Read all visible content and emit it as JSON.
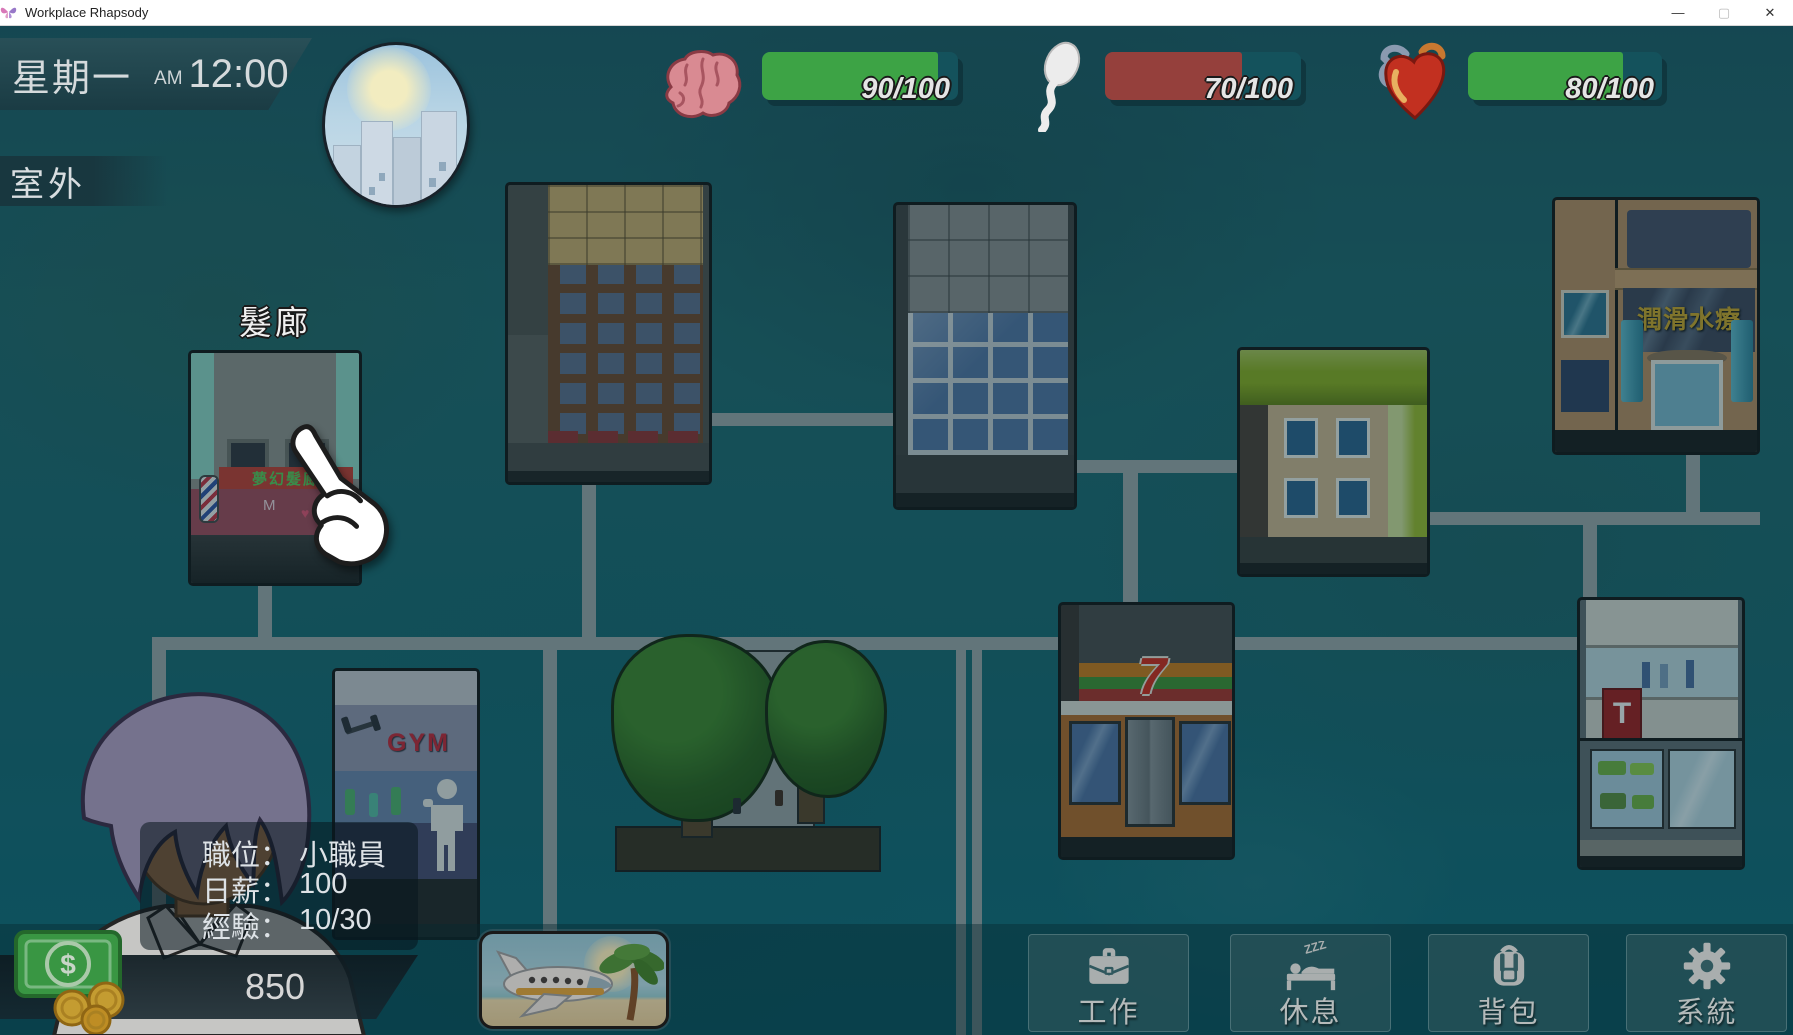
{
  "window": {
    "title": "Workplace Rhapsody",
    "app_icon": "butterfly-icon",
    "controls": {
      "minimize": "—",
      "maximize": "▢",
      "close": "✕"
    }
  },
  "hud": {
    "day": "星期一",
    "meridiem": "AM",
    "time": "12:00",
    "location": "室外",
    "weather_icon": "city-sunrise-icon",
    "track_color": "#14525c",
    "stats": [
      {
        "id": "intellect",
        "icon": "brain-icon",
        "value": 90,
        "max": 100,
        "label": "90/100",
        "fill_color": "#3da345"
      },
      {
        "id": "libido",
        "icon": "sperm-icon",
        "value": 70,
        "max": 100,
        "label": "70/100",
        "fill_color": "#95403c"
      },
      {
        "id": "health",
        "icon": "heart-icon",
        "value": 80,
        "max": 100,
        "label": "80/100",
        "fill_color": "#3da345"
      }
    ]
  },
  "map": {
    "buildings": [
      {
        "id": "hair-salon",
        "label": "髮廊",
        "sign": "夢幻髮廊",
        "front_letter": "M",
        "front_heart": "♥"
      },
      {
        "id": "apartment"
      },
      {
        "id": "office-tower"
      },
      {
        "id": "green-house"
      },
      {
        "id": "spa",
        "sign": "潤滑水療"
      },
      {
        "id": "gym",
        "sign": "GYM"
      },
      {
        "id": "park"
      },
      {
        "id": "convenience-store",
        "sign": "7"
      },
      {
        "id": "toy-store",
        "sign": "T"
      }
    ]
  },
  "player": {
    "avatar": "office-worker-portrait",
    "info": [
      {
        "label": "職位：",
        "value": "小職員"
      },
      {
        "label": "日薪：",
        "value": "100"
      },
      {
        "label": "經驗：",
        "value": "10/30"
      }
    ],
    "money": "850",
    "money_symbol": "$",
    "money_icon": "cash-and-coins-icon"
  },
  "actions": {
    "travel_icon": "airplane-vacation-icon",
    "buttons": [
      {
        "id": "work",
        "icon": "briefcase-icon",
        "label": "工作"
      },
      {
        "id": "rest",
        "icon": "bed-icon",
        "label": "休息",
        "zzz": "ZZZ"
      },
      {
        "id": "bag",
        "icon": "backpack-icon",
        "label": "背包"
      },
      {
        "id": "system",
        "icon": "gear-icon",
        "label": "系統"
      }
    ]
  }
}
